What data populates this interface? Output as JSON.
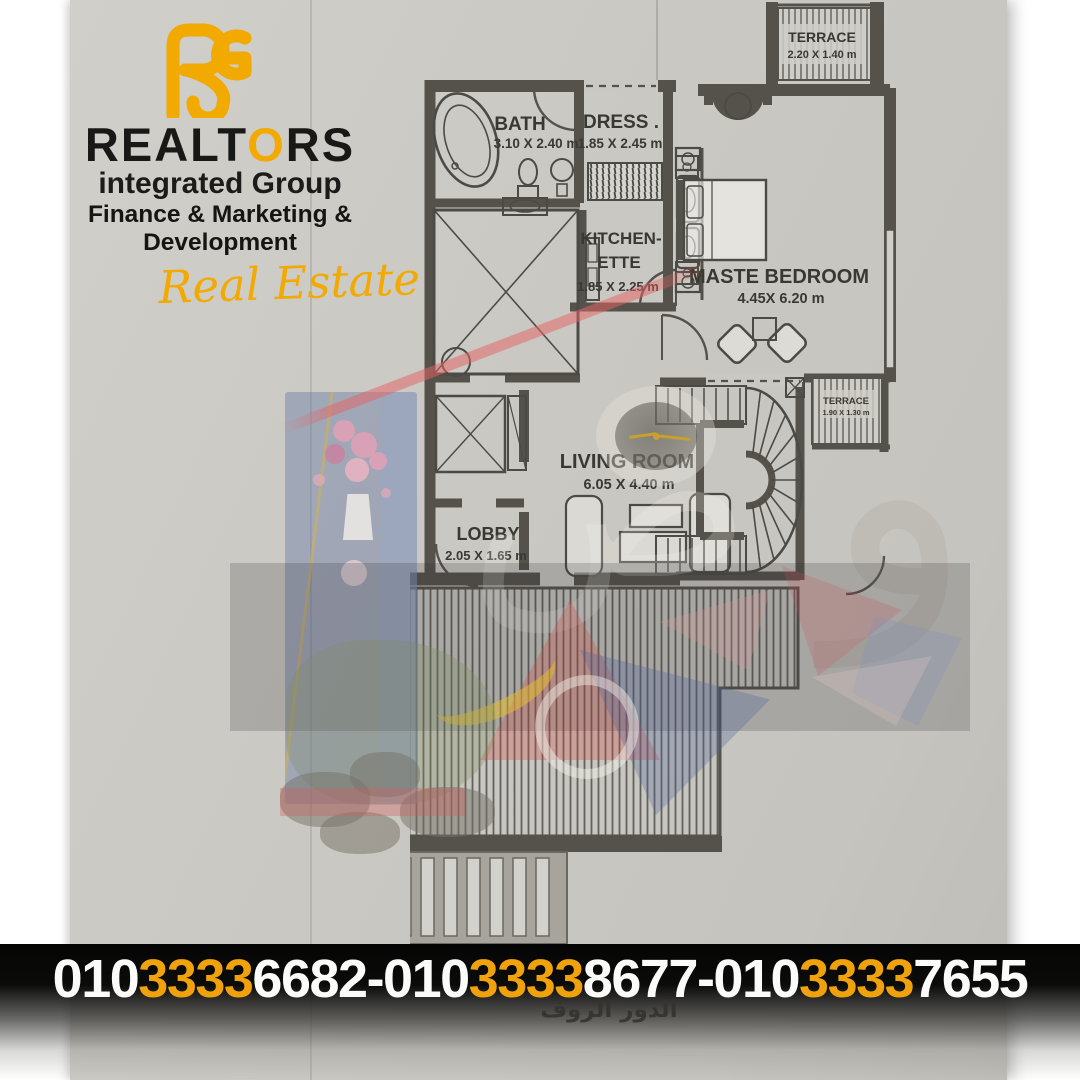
{
  "logo": {
    "brand_black_1": "REALT",
    "brand_accent": "O",
    "brand_black_2": "RS",
    "subtitle": "integrated Group",
    "tagline": "Finance & Marketing & Development",
    "script": "Real Estate"
  },
  "plan": {
    "rooms": [
      {
        "name": "TERRACE",
        "dims": "2.20 X 1.40 m"
      },
      {
        "name": "BATH",
        "dims": "3.10 X 2.40 m"
      },
      {
        "name": "DRESS .",
        "dims": "1.85 X 2.45 m"
      },
      {
        "name": "KITCHEN-",
        "name2": "ETTE",
        "dims": "1.85 X 2.25 m"
      },
      {
        "name": "MASTE BEDROOM",
        "dims": "4.45X 6.20 m"
      },
      {
        "name": "LIVING ROOM",
        "dims": "6.05 X 4.40  m"
      },
      {
        "name": "LOBBY",
        "dims": "2.05 X 1.65  m"
      },
      {
        "name": "TERRACE",
        "dims": "1.90 X 1.30 m"
      }
    ]
  },
  "watermark": {
    "glyph_1": "ص",
    "glyph_2": "و"
  },
  "banner": {
    "separator": "-",
    "phones": [
      {
        "p1": "010",
        "p2": "3333",
        "p3": "6682"
      },
      {
        "p1": "010",
        "p2": "3333",
        "p3": "8677"
      },
      {
        "p1": "010",
        "p2": "3333",
        "p3": "7655"
      }
    ]
  },
  "caption_ar": "الدور الروف",
  "colors": {
    "accent": "#F2A900",
    "digit_accent": "#EFA20B",
    "wall": "#55524B",
    "paper": "#CAC8C2"
  }
}
